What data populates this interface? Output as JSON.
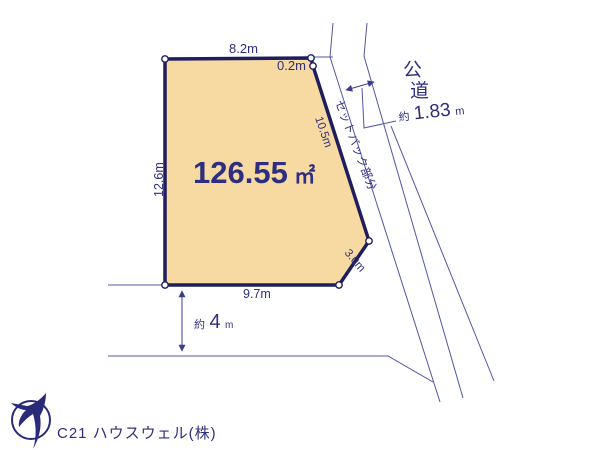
{
  "colors": {
    "background": "#ffffff",
    "plot_fill": "#f7d9a2",
    "plot_border": "#1e1e5e",
    "thin_line": "#5056a0",
    "dim_text": "#2e2e80",
    "logo_navy": "#2a2a7a",
    "footer_text": "#c6c6ce"
  },
  "plot": {
    "area_value": "126.55",
    "area_unit": "㎡"
  },
  "dimensions": {
    "top_edge": "8.2m",
    "top_jog": "0.2m",
    "left_edge": "12.6m",
    "bottom_edge": "9.7m",
    "right_upper_edge": "10.5m",
    "right_lower_edge": "3.0m",
    "road_width_prefix": "約",
    "road_width_value": "1.83",
    "road_width_unit": "m",
    "front_road_prefix": "約",
    "front_road_value": "4",
    "front_road_unit": "m"
  },
  "labels": {
    "setback": "セットバック部分",
    "road_chars": [
      "公",
      "道"
    ]
  },
  "footer": {
    "company": "C21 ハウスウェル(株)"
  }
}
